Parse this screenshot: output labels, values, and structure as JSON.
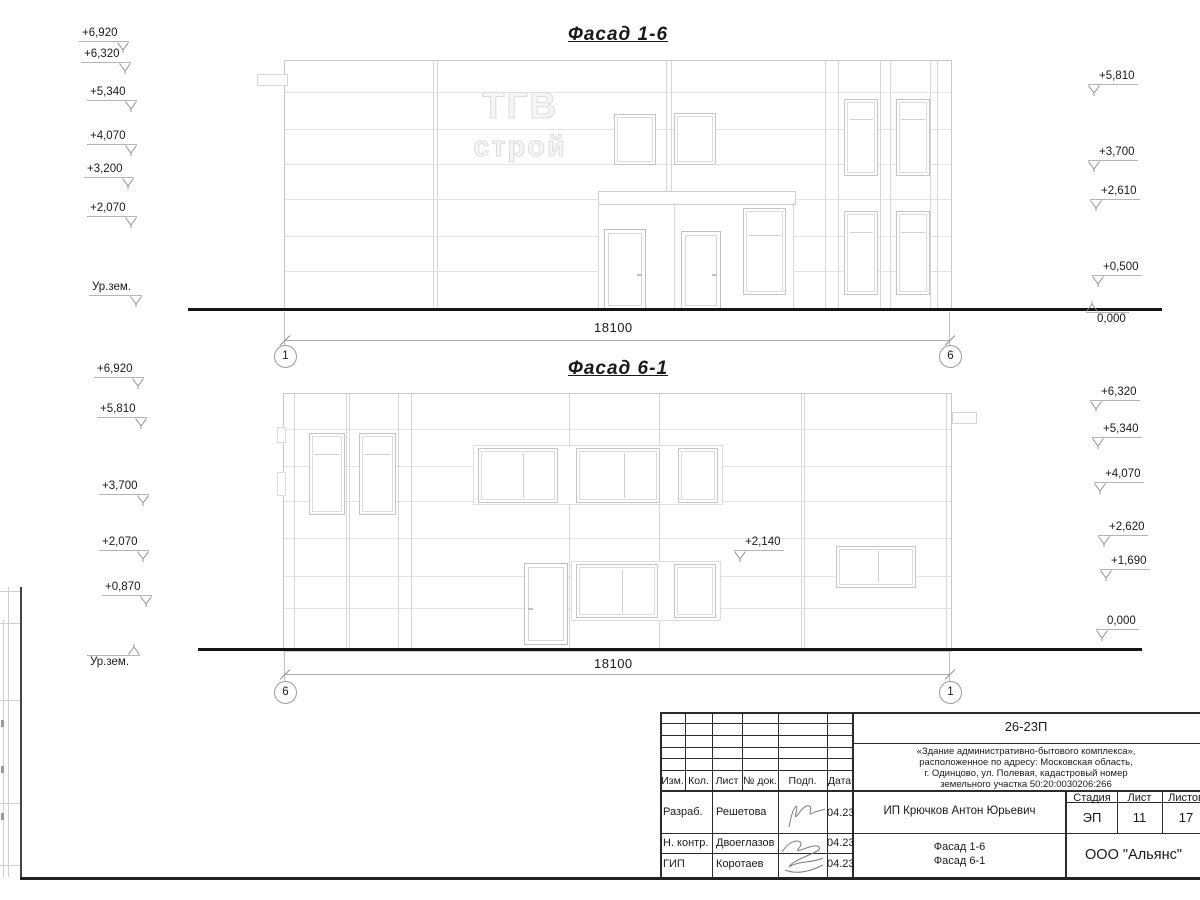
{
  "drawing": {
    "f1": {
      "title": "Фасад 1-6",
      "dim": "18100",
      "axis_left": "1",
      "axis_right": "6",
      "marks_left": [
        "+6,920",
        "+6,320",
        "+5,340",
        "+4,070",
        "+3,200",
        "+2,070",
        "Ур.зем."
      ],
      "marks_right": [
        "+5,810",
        "+3,700",
        "+2,610",
        "+0,500",
        "0,000"
      ],
      "logo_line1": "ТГВ",
      "logo_line2": "строй"
    },
    "f2": {
      "title": "Фасад 6-1",
      "dim": "18100",
      "axis_left": "6",
      "axis_right": "1",
      "marks_left": [
        "+6,920",
        "+5,810",
        "+3,700",
        "+2,070",
        "+0,870",
        "Ур.зем."
      ],
      "marks_right": [
        "+6,320",
        "+5,340",
        "+4,070",
        "+2,620",
        "+1,690",
        "0,000"
      ],
      "note": "+2,140"
    }
  },
  "titleblock": {
    "doc": "26-23П",
    "desc": [
      "«Здание административно-бытового комплекса»,",
      "расположенное по адресу: Московская область,",
      "г. Одинцово, ул. Полевая, кадастровый номер",
      "земельного участка 50:20:0030206:266"
    ],
    "cols": [
      "Изм.",
      "Кол.",
      "Лист",
      "№ док.",
      "Подп.",
      "Дата"
    ],
    "rows": [
      {
        "role": "Разраб.",
        "name": "Решетова",
        "date": "04.23"
      },
      {
        "role": "Н. контр.",
        "name": "Двоеглазов",
        "date": "04.23"
      },
      {
        "role": "ГИП",
        "name": "Коротаев",
        "date": "04.23"
      }
    ],
    "client": "ИП Крючков Антон Юрьевич",
    "stage_h": "Стадия",
    "sheet_h": "Лист",
    "sheets_h": "Листов",
    "stage": "ЭП",
    "sheet": "11",
    "sheets": "17",
    "content1": "Фасад 1-6",
    "content2": "Фасад 6-1",
    "company": "ООО \"Альянс\""
  },
  "colors": {
    "line_light": "#d6d6d6",
    "line_dark": "#1a1a1a",
    "ground": "#151515"
  }
}
